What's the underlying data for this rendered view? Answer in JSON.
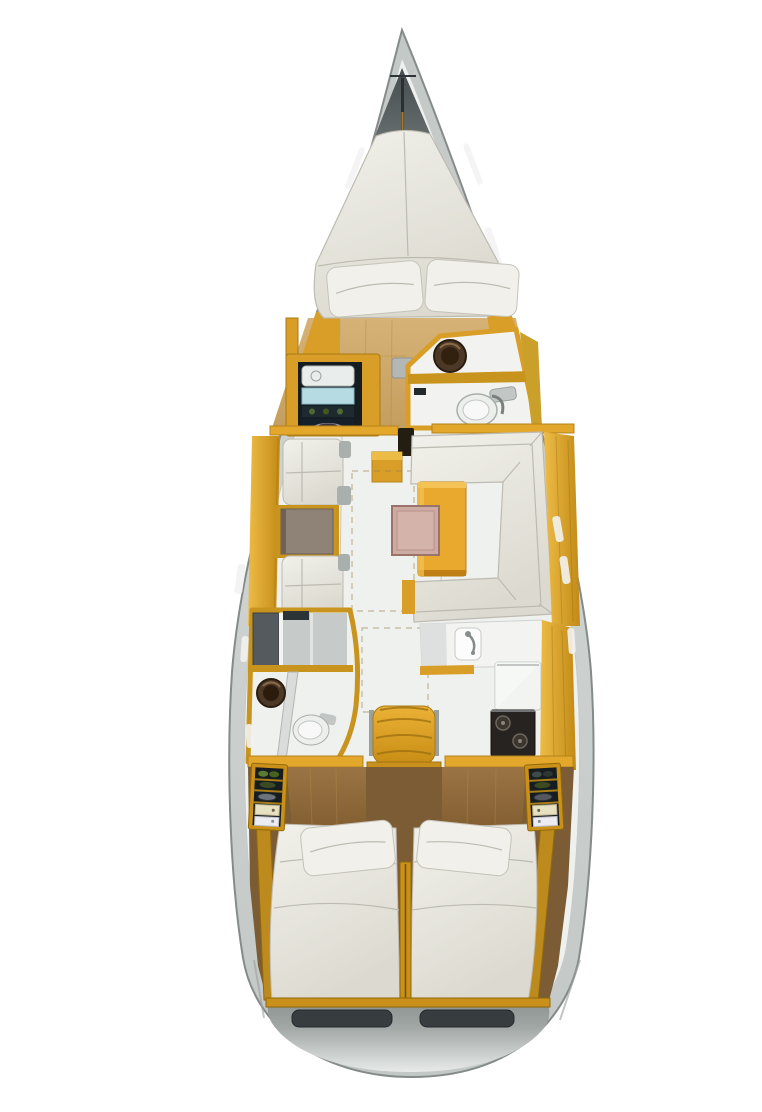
{
  "diagram": {
    "type": "boat-floor-plan",
    "view": "top-down interior layout of a sailing yacht",
    "regions": [
      {
        "id": "bow-anchor-locker"
      },
      {
        "id": "forward-cabin-v-berth"
      },
      {
        "id": "port-wardrobe-shelves"
      },
      {
        "id": "forward-head-toilet-sink"
      },
      {
        "id": "salon-port-settee-with-table"
      },
      {
        "id": "salon-u-shaped-settee"
      },
      {
        "id": "salon-dinette-table-with-pink-leaf"
      },
      {
        "id": "aft-head-with-shower"
      },
      {
        "id": "galley-sink-fridge-stove"
      },
      {
        "id": "companionway-steps"
      },
      {
        "id": "port-aft-cabin-double-berth"
      },
      {
        "id": "starboard-aft-cabin-double-berth"
      },
      {
        "id": "stern-transom-lockers"
      }
    ],
    "colors": {
      "background": "#ffffff",
      "hull": "#c3c8c6",
      "hull_edge": "#858b89",
      "deck": "#eff1ef",
      "bow_dark": "#454c4e",
      "bow_light": "#8f9694",
      "wood_light": "#d6b277",
      "wood_mid": "#c49e5e",
      "wood_aft": "#9a7444",
      "wood_aft_dark": "#7c5c34",
      "trim": "#d99e28",
      "trim_light": "#edbc46",
      "trim_dark": "#a87a14",
      "trim_deep": "#8f680a",
      "cushion": "#f1f0ea",
      "cushion_shadow": "#dcdad0",
      "cushion_line": "#bdbbb1",
      "table_taupe": "#8f8277",
      "pink_leaf": "#cdaaa2",
      "table_yellow": "#e9a92e",
      "dark_appliance": "#272320",
      "toilet": "#edefed",
      "fixture_gray": "#b3b7b5",
      "sink_bronze": "#4c3826",
      "sink_deep": "#2a1c0e",
      "shower": "#c6cac8",
      "locker": "#161d22",
      "cyan_item": "#b6dbe2",
      "shelf_green": "#5a7c32",
      "shelf_cream": "#e7e1c2",
      "shelf_white": "#ebecf1",
      "stern_top": "#a0a6a4",
      "stern_bottom": "#e7eae8",
      "recess": "#373c3e",
      "step_dark": "#3f2f12"
    }
  }
}
